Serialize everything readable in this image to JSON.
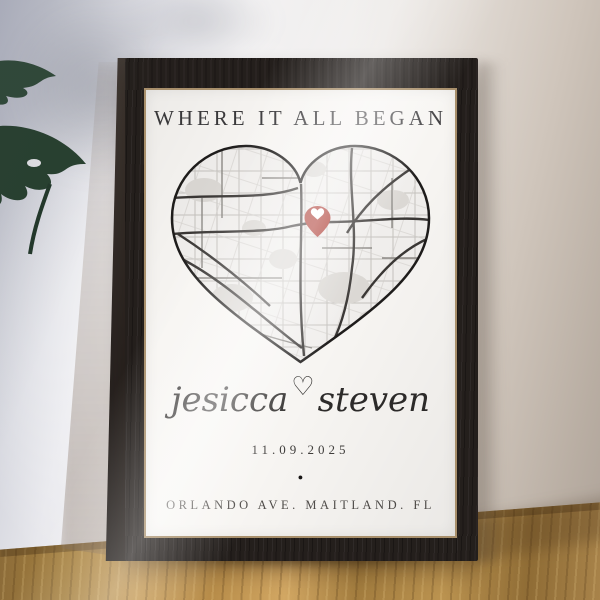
{
  "poster": {
    "title": "WHERE IT ALL BEGAN",
    "names": {
      "left": "jesicca",
      "heart_symbol": "♡",
      "right": "steven"
    },
    "date": "11.09.2025",
    "dot_symbol": "●",
    "address": "ORLANDO AVE. MAITLAND. FL"
  },
  "icons": {
    "map_pin": "heart-map-pin",
    "heart_divider": "♡"
  },
  "colors": {
    "pin_red": "#a93128",
    "pin_heart_white": "#ffffff",
    "frame_wood": "#241f1c",
    "poster_bg": "#f7f5f2",
    "map_outline": "#1e1c1b",
    "map_main_road": "#3a3735",
    "map_minor_road": "#c4c1bd",
    "map_patch": "#dbd8d4",
    "table_wood": "#b78c49",
    "wall_cool": "#b5b8c6",
    "wall_warm": "#ada298",
    "plant_green": "#2c4536"
  }
}
